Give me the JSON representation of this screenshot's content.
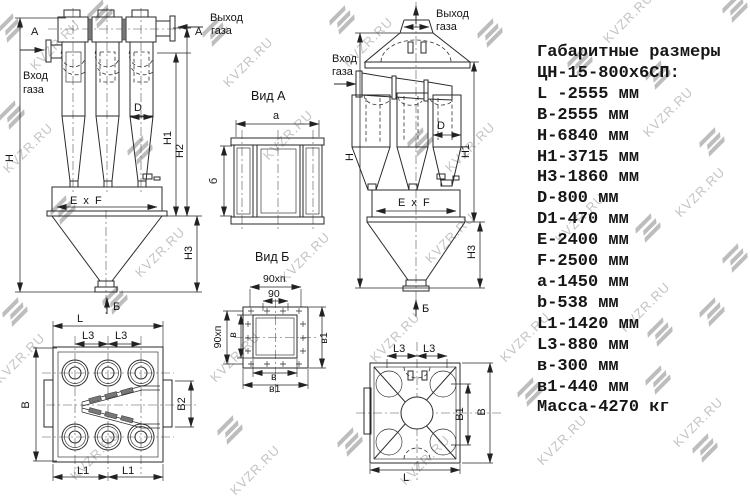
{
  "watermark": {
    "text": "KVZR.RU"
  },
  "specs": {
    "title": "Габаритные размеры",
    "model": "ЦН-15-800х6СП:",
    "items": [
      "L -2555 мм",
      "B-2555 мм",
      "H-6840 мм",
      "H1-3715 мм",
      "H3-1860 мм",
      "D-800 мм",
      "D1-470 мм",
      "E-2400 мм",
      "F-2500 мм",
      "a-1450 мм",
      "b-538 мм",
      "L1-1420 мм",
      "L3-880 мм",
      "в-300 мм",
      "в1-440 мм",
      "Масса-4270 кг"
    ]
  },
  "labels": {
    "inlet_line1": "Вход",
    "inlet_line2": "газа",
    "outlet_line1": "Выход",
    "outlet_line2": "газа",
    "section_a": "A",
    "section_b": "Б",
    "exf": "E x F",
    "h": "H",
    "h1": "H1",
    "h2": "H2",
    "h3": "H3",
    "d": "D",
    "l": "L",
    "l1": "L1",
    "l3": "L3",
    "b": "B",
    "b1": "B1",
    "b2": "B2",
    "a_dim": "a",
    "b_small": "б",
    "v": "в",
    "v1": "в1",
    "n90": "90",
    "n90xn": "90хп",
    "view_a_title": "Вид А",
    "view_b_title": "Вид Б"
  }
}
